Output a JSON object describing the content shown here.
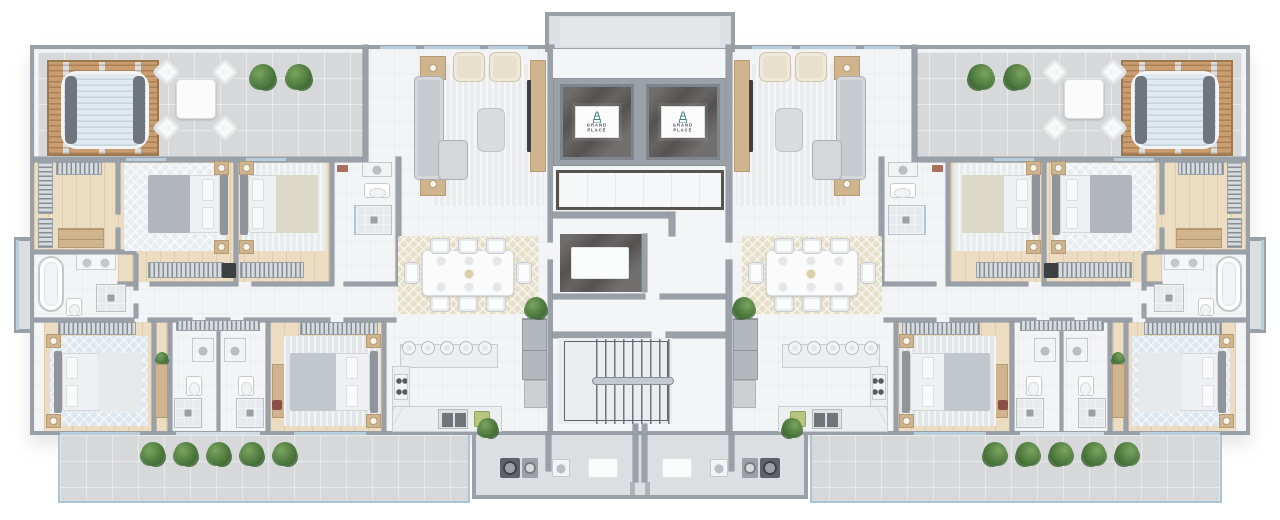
{
  "plan": {
    "brand": {
      "line1": "GRAND",
      "line2": "PLACE"
    },
    "building_core": {
      "elevators": [
        {
          "label_line1": "GRAND",
          "label_line2": "PLACE"
        },
        {
          "label_line1": "GRAND",
          "label_line2": "PLACE"
        }
      ],
      "features": [
        "elevator-lobby",
        "entry-foyer",
        "double-flight-staircase",
        "entrance-vestibules",
        "laundry-niches"
      ]
    },
    "units": [
      {
        "side": "left",
        "rooms": [
          "roof-terrace",
          "pergola-lounge",
          "living-room",
          "dining-area",
          "kitchen",
          "master-bedroom",
          "bedroom-2",
          "bedroom-3",
          "bedroom-4",
          "walk-in-closet",
          "master-bathroom",
          "ensuite-bathroom",
          "bathroom-3",
          "bathroom-4",
          "balcony"
        ],
        "furniture_counts": {
          "beds": 4,
          "dining_chairs": 8,
          "bar_stools": 5,
          "armchairs": 2,
          "outdoor_chairs": 4,
          "balcony_planters": 5,
          "freestanding_bathtub": 1
        }
      },
      {
        "side": "right",
        "rooms": [
          "roof-terrace",
          "pergola-lounge",
          "living-room",
          "dining-area",
          "kitchen",
          "master-bedroom",
          "bedroom-2",
          "bedroom-3",
          "bedroom-4",
          "walk-in-closet",
          "master-bathroom",
          "ensuite-bathroom",
          "bathroom-3",
          "bathroom-4",
          "balcony"
        ],
        "furniture_counts": {
          "beds": 4,
          "dining_chairs": 8,
          "bar_stools": 5,
          "armchairs": 2,
          "outdoor_chairs": 4,
          "balcony_planters": 5,
          "freestanding_bathtub": 1
        }
      }
    ],
    "palette": {
      "wall": "#99a0a8",
      "interior_floor": "#f3f4f6",
      "terrace_floor": "#d6d8da",
      "wood_floor": "#ecddc2",
      "glass": "#b9cedd",
      "marble_dark": "#565252",
      "pergola_wood": "#c99d6f",
      "plant_green": "#4e7a3e",
      "logo_teal": "#4a7f84"
    }
  }
}
